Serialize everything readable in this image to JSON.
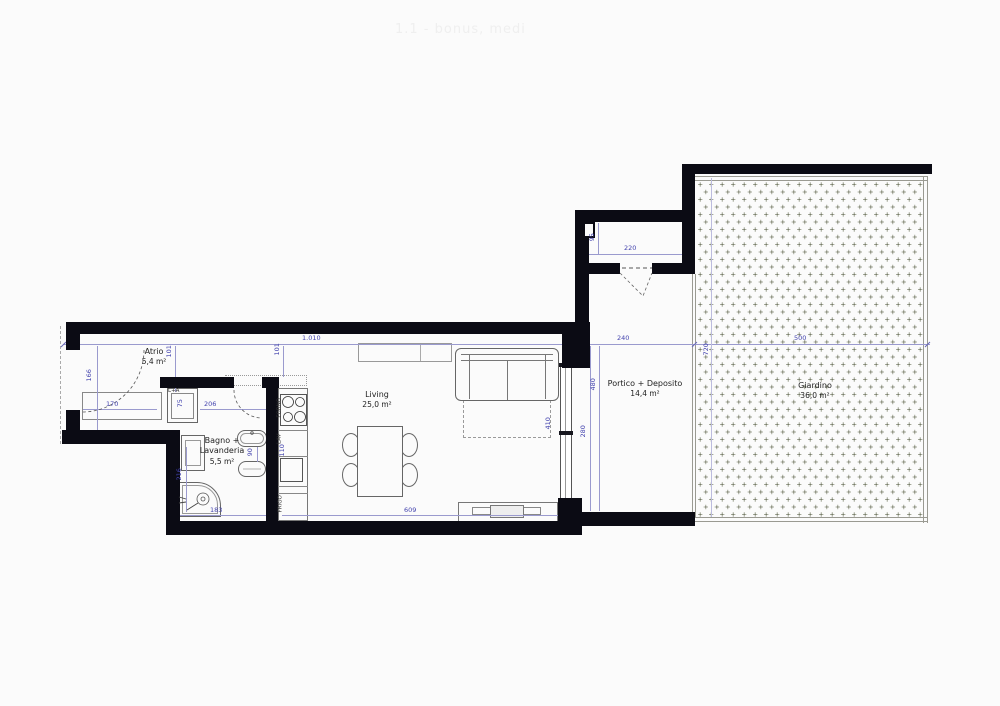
{
  "title_watermark": "1.1 - bonus, medi",
  "plan": {
    "rooms": [
      {
        "id": "atrio",
        "line1": "Atrio",
        "area": "5,4 m²"
      },
      {
        "id": "bagno",
        "line1": "Bagno +",
        "line2": "Lavanderia",
        "area": "5,5 m²"
      },
      {
        "id": "living",
        "line1": "Living",
        "area": "25,0 m²"
      },
      {
        "id": "portico",
        "line1": "Portico + Deposito",
        "area": "14,4 m²"
      },
      {
        "id": "giardino",
        "line1": "Giardino",
        "area": "36,0 m²"
      }
    ],
    "appliances": {
      "washer_dryer": "L+A",
      "oven": "FORNO",
      "sink": "LAV",
      "fridge": "FRIGO"
    },
    "dimensions": {
      "total_width": "1.010",
      "portico_width": "240",
      "garden_width": "500",
      "garden_depth": "720",
      "deposito_width": "220",
      "deposito_depth": "95",
      "offset_a": "101",
      "offset_b": "101",
      "entry_door": "166",
      "closet": "170",
      "hall": "206",
      "washer": "75",
      "bath_side": "216",
      "bath_gap": "90",
      "kitchen": "110",
      "bath_bottom": "183",
      "living_bottom": "609",
      "sofa_zone": "410",
      "portico_seg_a": "480",
      "portico_seg_b": "280"
    },
    "colors": {
      "wall": "#0b0b14",
      "dimension": "#4343ae",
      "garden_dot": "#8a8f7a"
    }
  }
}
